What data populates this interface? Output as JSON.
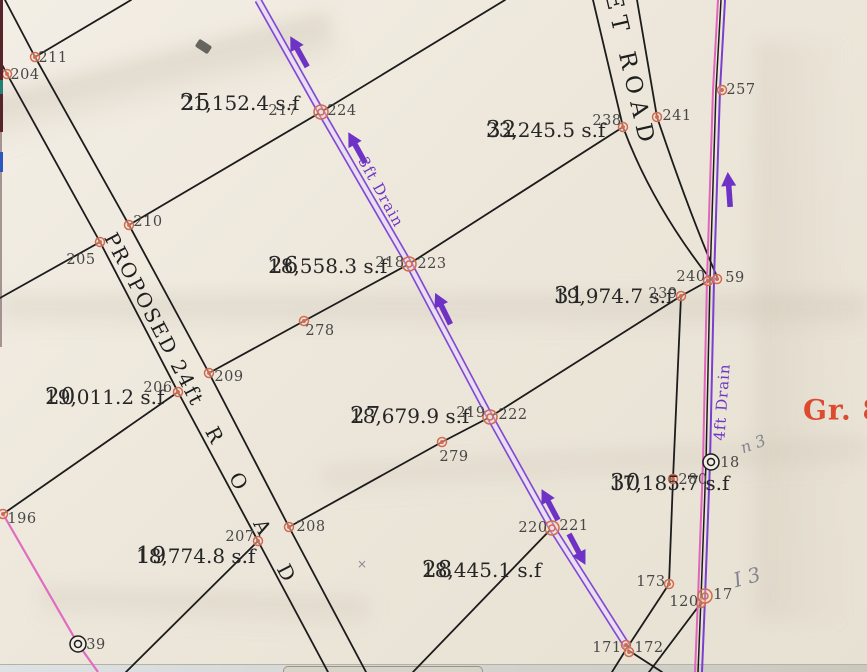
{
  "map": {
    "road_proposed": {
      "label_main": "PROPOSED 24ft",
      "label_road": "R O A D"
    },
    "road_top": {
      "label": "ET ROAD"
    },
    "drain_3ft_label": "3ft Drain",
    "drain_4ft_label": "4ft Drain",
    "red_annotation": "Gr. 8",
    "lots": [
      {
        "number": "25",
        "area": "21,152.4 s.f"
      },
      {
        "number": "32",
        "area": "23,245.5 s.f"
      },
      {
        "number": "26",
        "area": "18,558.3 s.f"
      },
      {
        "number": "31",
        "area": "19,974.7 s.f"
      },
      {
        "number": "20",
        "area": "19,011.2 s.f"
      },
      {
        "number": "27",
        "area": "18,679.9 s.f"
      },
      {
        "number": "30",
        "area": "17,185.7 s.f"
      },
      {
        "number": "19",
        "area": "18,774.8 s.f"
      },
      {
        "number": "28",
        "area": "18,445.1 s.f"
      }
    ],
    "point_labels": [
      {
        "t": "204",
        "x": 25,
        "y": 75
      },
      {
        "t": "211",
        "x": 53,
        "y": 58
      },
      {
        "t": "210",
        "x": 148,
        "y": 222
      },
      {
        "t": "205",
        "x": 81,
        "y": 260
      },
      {
        "t": "206",
        "x": 158,
        "y": 388
      },
      {
        "t": "209",
        "x": 229,
        "y": 377
      },
      {
        "t": "196",
        "x": 22,
        "y": 519
      },
      {
        "t": "207",
        "x": 240,
        "y": 537
      },
      {
        "t": "208",
        "x": 311,
        "y": 527
      },
      {
        "t": "278",
        "x": 320,
        "y": 331
      },
      {
        "t": "279",
        "x": 454,
        "y": 457
      },
      {
        "t": "217",
        "x": 283,
        "y": 111
      },
      {
        "t": "224",
        "x": 342,
        "y": 111
      },
      {
        "t": "218",
        "x": 390,
        "y": 263
      },
      {
        "t": "223",
        "x": 432,
        "y": 264
      },
      {
        "t": "219",
        "x": 471,
        "y": 413
      },
      {
        "t": "222",
        "x": 513,
        "y": 415
      },
      {
        "t": "220",
        "x": 533,
        "y": 528
      },
      {
        "t": "221",
        "x": 574,
        "y": 526
      },
      {
        "t": "171",
        "x": 607,
        "y": 648
      },
      {
        "t": "172",
        "x": 649,
        "y": 648
      },
      {
        "t": "173",
        "x": 651,
        "y": 582
      },
      {
        "t": "120",
        "x": 684,
        "y": 602
      },
      {
        "t": "17",
        "x": 723,
        "y": 595
      },
      {
        "t": "280",
        "x": 693,
        "y": 480
      },
      {
        "t": "18",
        "x": 730,
        "y": 463
      },
      {
        "t": "239",
        "x": 663,
        "y": 294
      },
      {
        "t": "240",
        "x": 691,
        "y": 277
      },
      {
        "t": "59",
        "x": 735,
        "y": 278
      },
      {
        "t": "238",
        "x": 607,
        "y": 121
      },
      {
        "t": "241",
        "x": 677,
        "y": 116
      },
      {
        "t": "257",
        "x": 741,
        "y": 90
      },
      {
        "t": "39",
        "x": 96,
        "y": 645
      }
    ],
    "markers": [
      {
        "x": 7,
        "y": 74,
        "t": "dot"
      },
      {
        "x": 35,
        "y": 57,
        "t": "dot"
      },
      {
        "x": 129,
        "y": 225,
        "t": "dot"
      },
      {
        "x": 100,
        "y": 242,
        "t": "dot"
      },
      {
        "x": 178,
        "y": 392,
        "t": "dot"
      },
      {
        "x": 209,
        "y": 373,
        "t": "dot"
      },
      {
        "x": 3,
        "y": 514,
        "t": "dot"
      },
      {
        "x": 258,
        "y": 541,
        "t": "dot"
      },
      {
        "x": 289,
        "y": 527,
        "t": "dot"
      },
      {
        "x": 304,
        "y": 321,
        "t": "dot"
      },
      {
        "x": 442,
        "y": 442,
        "t": "dot"
      },
      {
        "x": 623,
        "y": 127,
        "t": "dot"
      },
      {
        "x": 657,
        "y": 117,
        "t": "dot"
      },
      {
        "x": 722,
        "y": 90,
        "t": "dot"
      },
      {
        "x": 681,
        "y": 296,
        "t": "dot"
      },
      {
        "x": 708,
        "y": 281,
        "t": "dot"
      },
      {
        "x": 717,
        "y": 279,
        "t": "dot"
      },
      {
        "x": 673,
        "y": 479,
        "t": "dot"
      },
      {
        "x": 669,
        "y": 584,
        "t": "dot"
      },
      {
        "x": 701,
        "y": 603,
        "t": "dot"
      },
      {
        "x": 626,
        "y": 645,
        "t": "dot"
      },
      {
        "x": 629,
        "y": 652,
        "t": "dot"
      },
      {
        "x": 321,
        "y": 112,
        "t": "x2o"
      },
      {
        "x": 409,
        "y": 264,
        "t": "x2o"
      },
      {
        "x": 490,
        "y": 417,
        "t": "x2o"
      },
      {
        "x": 552,
        "y": 528,
        "t": "x2o"
      },
      {
        "x": 705,
        "y": 596,
        "t": "x2o"
      },
      {
        "x": 711,
        "y": 462,
        "t": "x2b"
      },
      {
        "x": 78,
        "y": 644,
        "t": "x2b"
      }
    ],
    "arrows": [
      {
        "x": 299,
        "y": 52,
        "a": -119
      },
      {
        "x": 357,
        "y": 148,
        "a": -119
      },
      {
        "x": 443,
        "y": 309,
        "a": -116
      },
      {
        "x": 550,
        "y": 505,
        "a": -118
      },
      {
        "x": 577,
        "y": 549,
        "a": 62
      },
      {
        "x": 729,
        "y": 190,
        "a": -94
      }
    ],
    "pencil_notes": [
      {
        "text": "n 3",
        "x": 753,
        "y": 444,
        "rot": -20,
        "size": 16
      },
      {
        "text": "I 3",
        "x": 747,
        "y": 577,
        "rot": -15,
        "size": 20
      },
      {
        "text": "×",
        "x": 362,
        "y": 564,
        "rot": 0,
        "size": 12
      }
    ]
  },
  "colors": {
    "paper": "#ede7db",
    "ink": "#1c1c1c",
    "drain_purple": "#7a3ed0",
    "drain_fill": "#e8dff1",
    "magenta_line": "#e263bd",
    "point_orange": "#cf6b52",
    "red_annotation": "#dd4a2e",
    "pencil_grey": "#84848e",
    "arrow_purple": "#6f32c6"
  }
}
